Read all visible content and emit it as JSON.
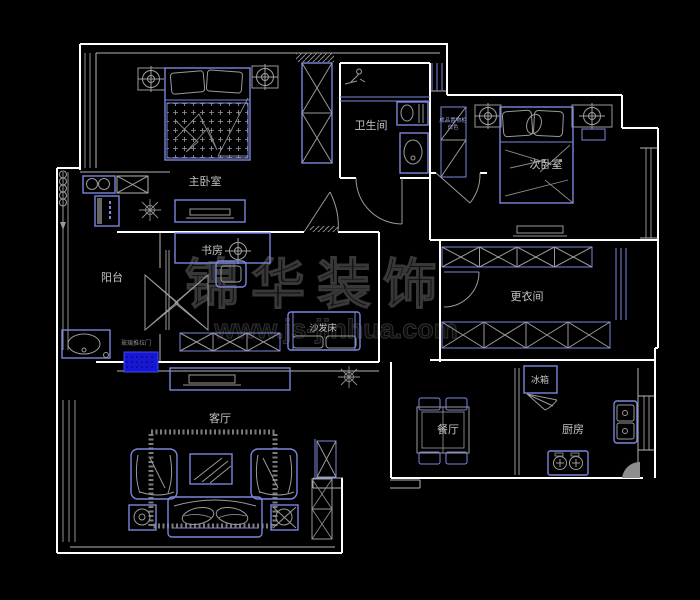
{
  "drawing_type": "apartment-floor-plan",
  "colors": {
    "background": "#000000",
    "wall": "#ffffff",
    "furniture": "#7b87dd",
    "detail": "#9a9a9a",
    "threshold_fill": "#1717d6",
    "watermark": "#333333",
    "label": "#c4c4c4"
  },
  "labels": {
    "master_bedroom": "主卧室",
    "bathroom": "卫生间",
    "second_bedroom": "次卧室",
    "balcony": "阳台",
    "study": "书房",
    "sofa_bed": "沙发床",
    "dressing_room": "更衣间",
    "living_room": "客厅",
    "dining_room": "餐厅",
    "kitchen": "厨房",
    "fridge": "冰箱",
    "cabinet_note_line1": "成品置物柜",
    "cabinet_note_line2": "白色",
    "sliding_door_note": "玻璃推拉门"
  },
  "watermark": {
    "brand": "锦华装饰",
    "url": "www.js-jinhua.com"
  }
}
